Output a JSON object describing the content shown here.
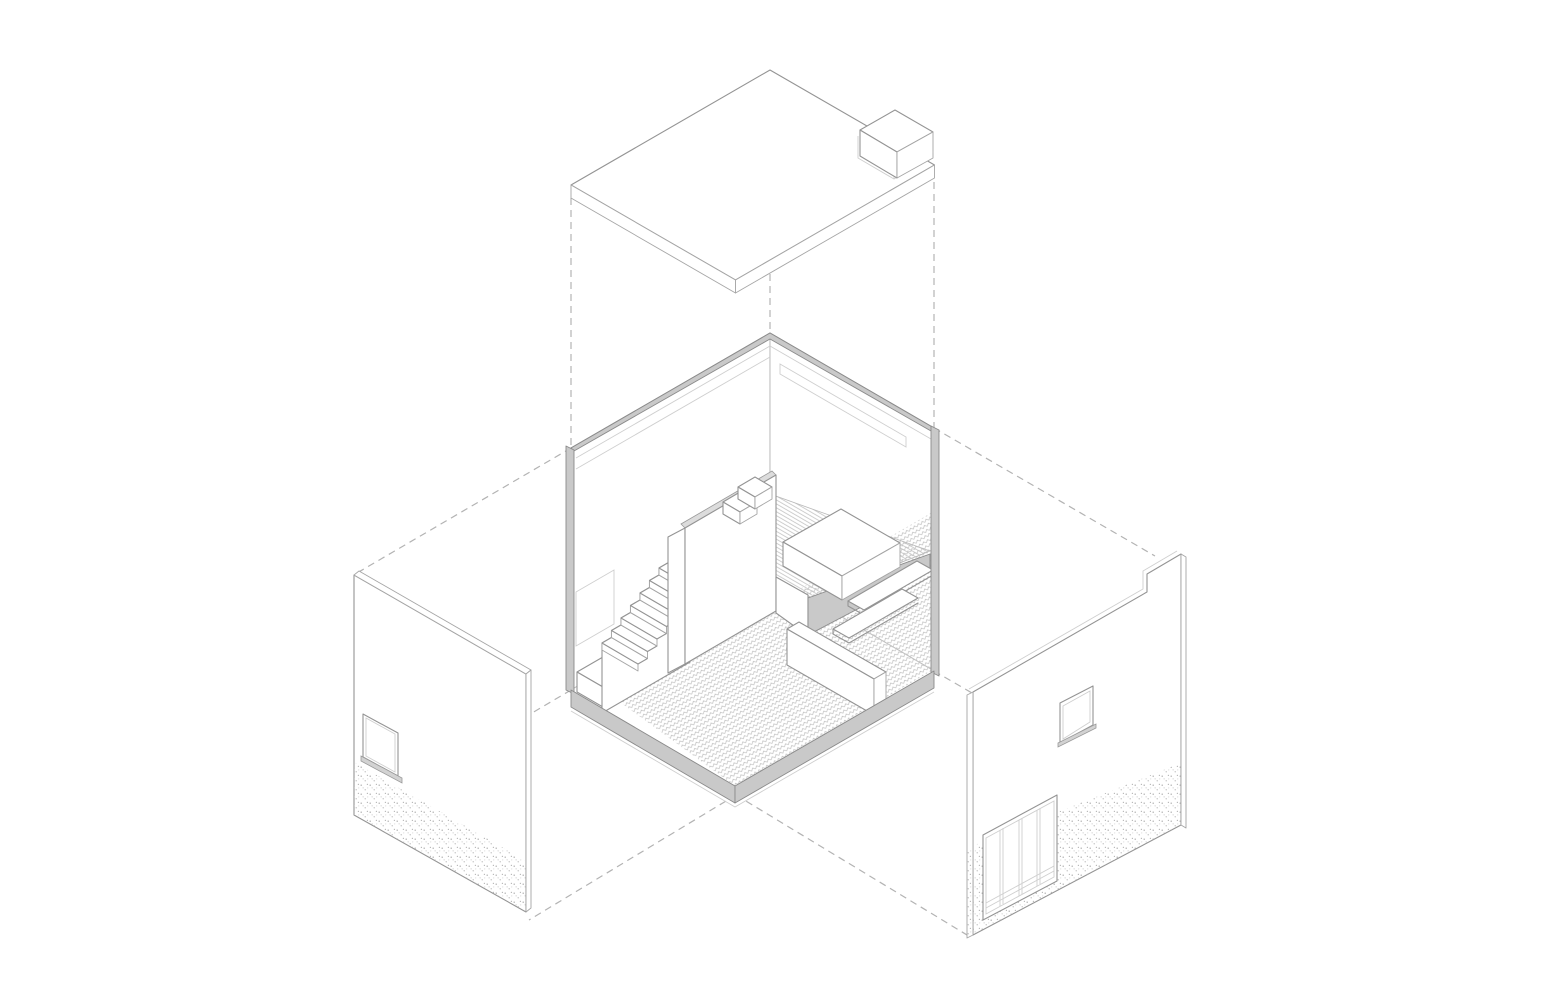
{
  "page": {
    "background": "#ffffff",
    "kind": "exploded axonometric architectural diagram"
  },
  "palette": {
    "line": "#949494",
    "line_faint": "#cfcfcf",
    "poche_fill": "#c9c9c9",
    "dash_line": "#b3b3b3",
    "paper": "#ffffff"
  },
  "components": {
    "roof": {
      "label": "Flat roof slab lifted above the room, with notched corner and rooftop box volume"
    },
    "guides": {
      "label": "Dashed projection guide lines linking exploded parts",
      "count": 9,
      "style": "dashed"
    },
    "room": {
      "label": "Sectioned room volume with two interior walls, cut edges shown in grey",
      "features": [
        "clerestory slot window on right wall",
        "panel outline on left wall",
        "grey poche cut edges",
        "floor slab edge"
      ]
    },
    "mezzanine": {
      "label": "Sleeping mezzanine with striped deck, bed, guard parapet and diagonal deck edge"
    },
    "stairs": {
      "label": "Straight staircase to mezzanine",
      "step_count": 8,
      "top_step_count": 2,
      "landing": "entry landing block"
    },
    "furniture": {
      "counter_label": "L-shaped counter below mezzanine",
      "shelf_count": 2,
      "shelf_label": "wall shelves in lower nook"
    },
    "floor": {
      "label": "Ground floor with herringbone parquet pattern",
      "pattern": "herringbone"
    },
    "left_panel": {
      "label": "Left facade wall panel pulled away",
      "features": [
        "square window with sill",
        "stippled base band"
      ]
    },
    "right_panel": {
      "label": "Right facade wall panel pulled away",
      "features": [
        "raised notch at top corner",
        "small square window",
        "glazed entry screen",
        "stippled base band"
      ],
      "glazing_panes": 4
    }
  }
}
